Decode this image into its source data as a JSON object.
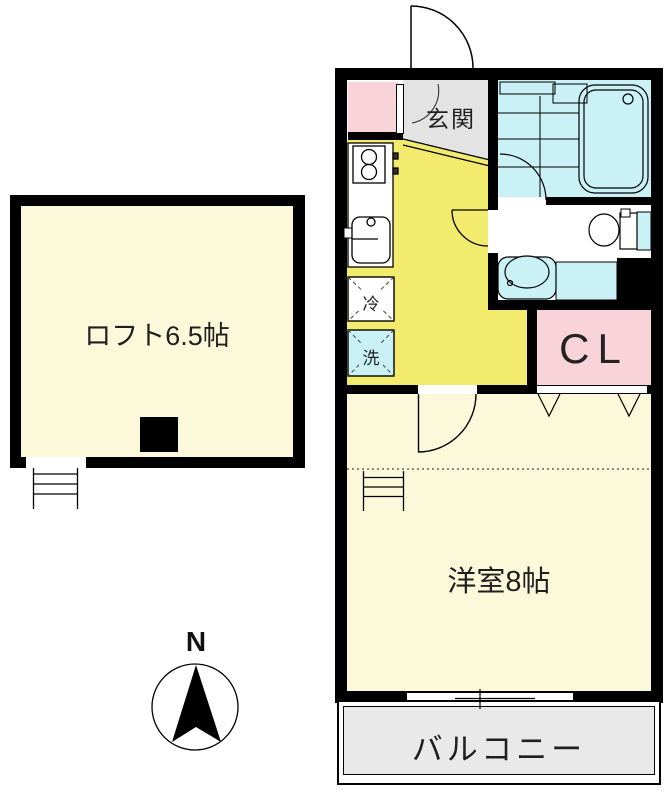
{
  "areas": {
    "loft": {
      "label": "ロフト6.5帖",
      "size_tatami": 6.5,
      "fill": "#fcf9da"
    },
    "western_room": {
      "label": "洋室8帖",
      "size_tatami": 8,
      "fill": "#fcf9da"
    },
    "kitchen": {
      "fill": "#f3eb6e"
    },
    "entrance": {
      "label": "玄関",
      "fill": "#e3e3e3"
    },
    "bathroom": {
      "fill": "#c9f1f6"
    },
    "washroom": {
      "fill": "#ffffff"
    },
    "closet": {
      "label": "CL",
      "fill": "#f9d3da"
    },
    "shoe_cabinet": {
      "fill": "#f9d3da"
    },
    "balcony": {
      "label": "バルコニー",
      "fill": "#e9e9e9"
    }
  },
  "fixtures": {
    "fridge": {
      "label": "冷"
    },
    "washer": {
      "label": "洗"
    }
  },
  "compass": {
    "north_label": "N"
  },
  "colors": {
    "wall": "#000000",
    "line": "#1a1a1a",
    "text": "#1f1f1f"
  }
}
